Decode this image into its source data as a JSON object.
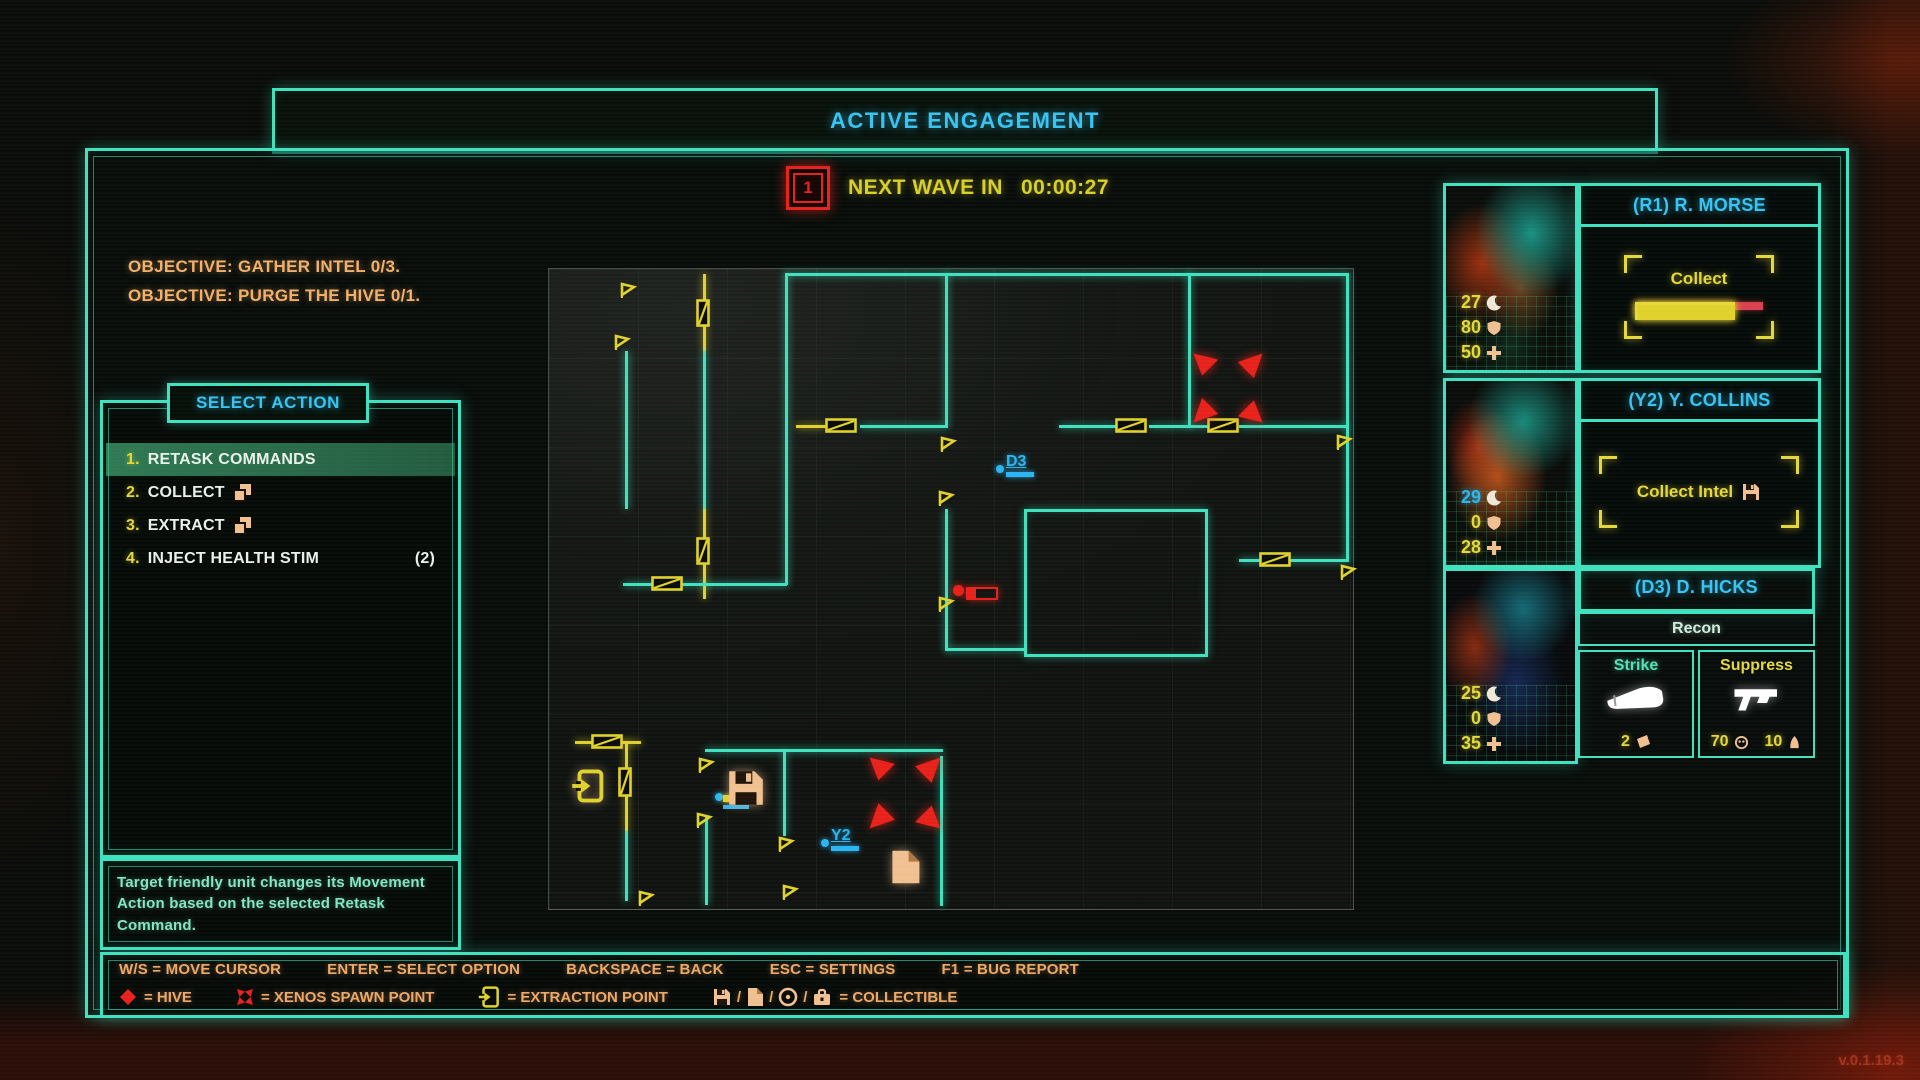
{
  "screen": {
    "title": "ACTIVE ENGAGEMENT",
    "version": "v.0.1.19.3"
  },
  "wave": {
    "icon_number": "1",
    "label": "NEXT WAVE IN",
    "time": "00:00:27",
    "accent": "#e8221a",
    "text_color": "#d8d02a"
  },
  "objectives": {
    "line1": "OBJECTIVE: GATHER INTEL 0/3.",
    "line2": "OBJECTIVE: PURGE THE HIVE 0/1."
  },
  "action_menu": {
    "title": "SELECT ACTION",
    "items": [
      {
        "num": "1.",
        "label": "RETASK COMMANDS",
        "selected": true
      },
      {
        "num": "2.",
        "label": "COLLECT",
        "icon": "stack-papers-icon"
      },
      {
        "num": "3.",
        "label": "EXTRACT",
        "icon": "stack-papers-icon"
      },
      {
        "num": "4.",
        "label": "INJECT HEALTH STIM",
        "count": "(2)"
      }
    ],
    "description": "Target friendly unit changes its Movement Action based on the selected Retask Command."
  },
  "hints": [
    "W/S = MOVE CURSOR",
    "ENTER = SELECT OPTION",
    "BACKSPACE = BACK",
    "ESC = SETTINGS",
    "F1 = BUG REPORT"
  ],
  "legend": {
    "hive": {
      "icon": "hive-diamond-icon",
      "label": "= HIVE"
    },
    "spawn": {
      "icon": "xenos-spawn-icon",
      "label": "= XENOS SPAWN POINT"
    },
    "extraction": {
      "icon": "extraction-door-icon",
      "label": "= EXTRACTION POINT"
    },
    "collectible": {
      "icons": [
        "floppy-disk-icon",
        "document-icon",
        "disc-icon",
        "briefcase-icon"
      ],
      "slash": "/",
      "label": "= COLLECTIBLE"
    }
  },
  "squad": [
    {
      "callsign": "(R1) R. MORSE",
      "stats": [
        {
          "v": "27",
          "icon": "crescent-icon"
        },
        {
          "v": "80",
          "icon": "shield-icon"
        },
        {
          "v": "50",
          "icon": "plus-icon"
        }
      ],
      "action": {
        "label": "Collect",
        "progress_pct": 76
      }
    },
    {
      "callsign": "(Y2) Y. COLLINS",
      "stats": [
        {
          "v": "29",
          "icon": "crescent-icon",
          "blue": true
        },
        {
          "v": "0",
          "icon": "shield-icon"
        },
        {
          "v": "28",
          "icon": "plus-icon"
        }
      ],
      "action": {
        "label": "Collect Intel",
        "icon": "floppy-disk-icon"
      }
    },
    {
      "callsign": "(D3) D. HICKS",
      "class_label": "Recon",
      "stats": [
        {
          "v": "25",
          "icon": "crescent-icon"
        },
        {
          "v": "0",
          "icon": "shield-icon"
        },
        {
          "v": "35",
          "icon": "plus-icon"
        }
      ],
      "abilities": [
        {
          "label": "Strike",
          "color": "#54e0b4",
          "icon": "knife-icon",
          "ammo": "2",
          "ammo_icon": "magazine-icon"
        },
        {
          "label": "Suppress",
          "color": "#e5d83a",
          "icon": "pistol-icon",
          "stat1": "70",
          "stat1_icon": "orb-icon",
          "stat2": "10",
          "stat2_icon": "cone-icon"
        }
      ]
    }
  ],
  "map": {
    "walls": [
      {
        "x": 236,
        "y": 4,
        "w": 564,
        "h": 3,
        "c": "t"
      },
      {
        "x": 76,
        "y": 82,
        "w": 3,
        "h": 158,
        "c": "t"
      },
      {
        "x": 154,
        "y": 5,
        "w": 3,
        "h": 77,
        "c": "y"
      },
      {
        "x": 154,
        "y": 82,
        "w": 3,
        "h": 158,
        "c": "t"
      },
      {
        "x": 154,
        "y": 240,
        "w": 3,
        "h": 90,
        "c": "y"
      },
      {
        "x": 236,
        "y": 4,
        "w": 3,
        "h": 312,
        "c": "t"
      },
      {
        "x": 396,
        "y": 4,
        "w": 3,
        "h": 152,
        "c": "t"
      },
      {
        "x": 396,
        "y": 240,
        "w": 3,
        "h": 142,
        "c": "t"
      },
      {
        "x": 247,
        "y": 156,
        "w": 30,
        "h": 3,
        "c": "y"
      },
      {
        "x": 311,
        "y": 156,
        "w": 88,
        "h": 3,
        "c": "t"
      },
      {
        "x": 510,
        "y": 156,
        "w": 58,
        "h": 3,
        "c": "t"
      },
      {
        "x": 600,
        "y": 156,
        "w": 42,
        "h": 3,
        "c": "t"
      },
      {
        "x": 639,
        "y": 4,
        "w": 3,
        "h": 155,
        "c": "t"
      },
      {
        "x": 642,
        "y": 156,
        "w": 18,
        "h": 3,
        "c": "t"
      },
      {
        "x": 690,
        "y": 156,
        "w": 110,
        "h": 3,
        "c": "t"
      },
      {
        "x": 797,
        "y": 4,
        "w": 3,
        "h": 155,
        "c": "t"
      },
      {
        "x": 797,
        "y": 159,
        "w": 3,
        "h": 133,
        "c": "t"
      },
      {
        "x": 690,
        "y": 290,
        "w": 110,
        "h": 3,
        "c": "t"
      },
      {
        "x": 74,
        "y": 314,
        "w": 164,
        "h": 3,
        "c": "t"
      },
      {
        "x": 397,
        "y": 379,
        "w": 80,
        "h": 3,
        "c": "t"
      },
      {
        "x": 26,
        "y": 472,
        "w": 66,
        "h": 3,
        "c": "y"
      },
      {
        "x": 156,
        "y": 480,
        "w": 238,
        "h": 3,
        "c": "t"
      },
      {
        "x": 76,
        "y": 472,
        "w": 3,
        "h": 90,
        "c": "y"
      },
      {
        "x": 76,
        "y": 562,
        "w": 3,
        "h": 70,
        "c": "t"
      },
      {
        "x": 156,
        "y": 548,
        "w": 3,
        "h": 88,
        "c": "t"
      },
      {
        "x": 234,
        "y": 483,
        "w": 3,
        "h": 84,
        "c": "t"
      },
      {
        "x": 391,
        "y": 487,
        "w": 3,
        "h": 150,
        "c": "t"
      }
    ],
    "room_box": {
      "x": 475,
      "y": 240,
      "w": 178,
      "h": 142
    },
    "doors": [
      {
        "x": 147,
        "y": 30,
        "w": 14,
        "h": 28
      },
      {
        "x": 147,
        "y": 268,
        "w": 14,
        "h": 28
      },
      {
        "x": 276,
        "y": 149,
        "w": 32,
        "h": 15
      },
      {
        "x": 566,
        "y": 149,
        "w": 32,
        "h": 15
      },
      {
        "x": 658,
        "y": 149,
        "w": 32,
        "h": 15
      },
      {
        "x": 710,
        "y": 283,
        "w": 32,
        "h": 15
      },
      {
        "x": 102,
        "y": 307,
        "w": 32,
        "h": 15
      },
      {
        "x": 42,
        "y": 465,
        "w": 32,
        "h": 15
      },
      {
        "x": 69,
        "y": 498,
        "w": 14,
        "h": 30
      }
    ],
    "flags": [
      {
        "x": 70,
        "y": 12
      },
      {
        "x": 64,
        "y": 64
      },
      {
        "x": 390,
        "y": 166
      },
      {
        "x": 388,
        "y": 220
      },
      {
        "x": 388,
        "y": 326
      },
      {
        "x": 786,
        "y": 164
      },
      {
        "x": 790,
        "y": 294
      },
      {
        "x": 148,
        "y": 487
      },
      {
        "x": 146,
        "y": 542
      },
      {
        "x": 228,
        "y": 566
      },
      {
        "x": 232,
        "y": 614
      },
      {
        "x": 88,
        "y": 620
      }
    ],
    "spawn_points": [
      {
        "x": 642,
        "y": 82,
        "s": 74
      },
      {
        "x": 318,
        "y": 486,
        "s": 76
      }
    ],
    "units": [
      {
        "id": "D3",
        "x": 447,
        "y": 196,
        "style": "labeled"
      },
      {
        "id": "Y2",
        "x": 272,
        "y": 570,
        "style": "labeled"
      },
      {
        "id": "",
        "x": 166,
        "y": 524,
        "style": "busy"
      }
    ],
    "hive": {
      "x": 404,
      "y": 316
    },
    "collectibles": [
      {
        "type": "extraction-door-icon",
        "x": 22,
        "y": 500,
        "s": 34
      },
      {
        "type": "floppy-disk-icon",
        "x": 176,
        "y": 498,
        "s": 42
      },
      {
        "type": "document-icon",
        "x": 338,
        "y": 580,
        "s": 36
      }
    ]
  }
}
